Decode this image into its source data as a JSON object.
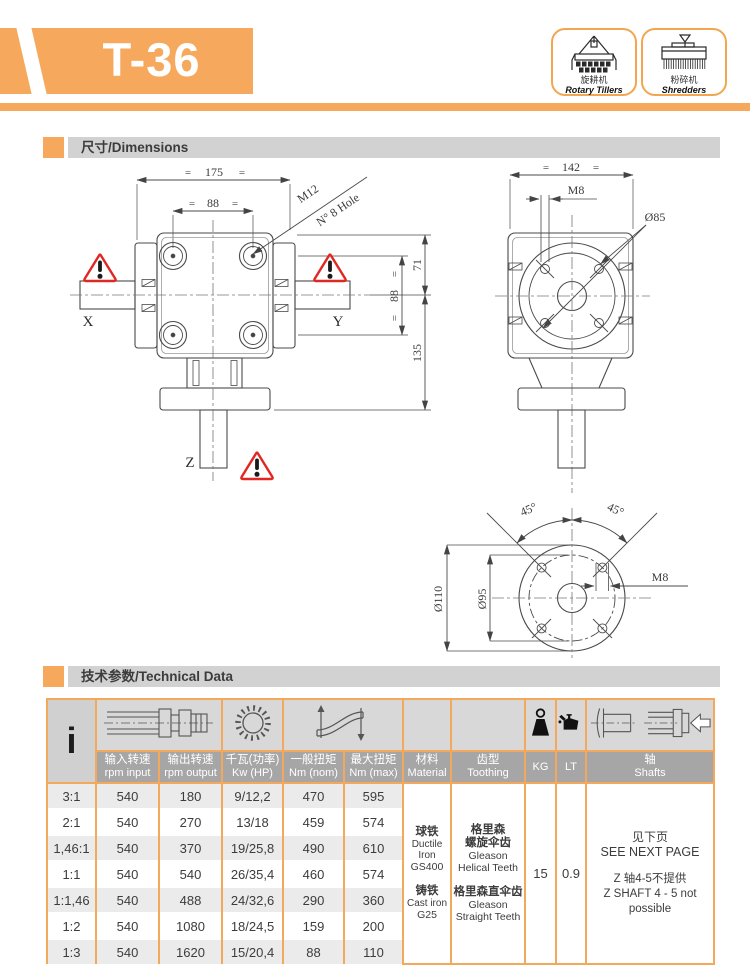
{
  "header": {
    "model": "T-36",
    "machines": [
      {
        "cn": "旋耕机",
        "en": "Rotary Tillers"
      },
      {
        "cn": "粉碎机",
        "en": "Shredders"
      }
    ]
  },
  "sections": {
    "dimensions": {
      "title": "尺寸/Dimensions"
    },
    "technical": {
      "title": "技术参数/Technical Data"
    }
  },
  "drawing": {
    "front": {
      "eq": "=",
      "dim_total": "175",
      "dim_holes": "88",
      "callout1": "M12",
      "callout2": "N° 8 Hole",
      "dim_h_top": "71",
      "dim_h_mid": "88",
      "dim_h_bot": "135",
      "x": "X",
      "y": "Y",
      "z": "Z"
    },
    "side": {
      "eq": "=",
      "dim_total": "142",
      "m8": "M8",
      "d85": "Ø85"
    },
    "flange": {
      "a1": "45°",
      "a2": "45°",
      "d110": "Ø110",
      "d95": "Ø95",
      "m8": "M8"
    }
  },
  "table": {
    "ratio_symbol": "i",
    "columns": [
      {
        "cn": "输入转速",
        "en": "rpm input"
      },
      {
        "cn": "输出转速",
        "en": "rpm output"
      },
      {
        "cn": "千瓦(功率)",
        "en": "Kw (HP)"
      },
      {
        "cn": "一般扭矩",
        "en": "Nm (nom)"
      },
      {
        "cn": "最大扭矩",
        "en": "Nm (max)"
      },
      {
        "cn": "材料",
        "en": "Material"
      },
      {
        "cn": "齿型",
        "en": "Toothing"
      },
      {
        "cn": "",
        "en": "KG"
      },
      {
        "cn": "",
        "en": "LT"
      },
      {
        "cn": "轴",
        "en": "Shafts"
      }
    ],
    "rows": [
      {
        "ratio": "3:1",
        "input": "540",
        "output": "180",
        "kw_hp": "9/12,2",
        "nm_nom": "470",
        "nm_max": "595"
      },
      {
        "ratio": "2:1",
        "input": "540",
        "output": "270",
        "kw_hp": "13/18",
        "nm_nom": "459",
        "nm_max": "574"
      },
      {
        "ratio": "1,46:1",
        "input": "540",
        "output": "370",
        "kw_hp": "19/25,8",
        "nm_nom": "490",
        "nm_max": "610"
      },
      {
        "ratio": "1:1",
        "input": "540",
        "output": "540",
        "kw_hp": "26/35,4",
        "nm_nom": "460",
        "nm_max": "574"
      },
      {
        "ratio": "1:1,46",
        "input": "540",
        "output": "488",
        "kw_hp": "24/32,6",
        "nm_nom": "290",
        "nm_max": "360"
      },
      {
        "ratio": "1:2",
        "input": "540",
        "output": "1080",
        "kw_hp": "18/24,5",
        "nm_nom": "159",
        "nm_max": "200"
      },
      {
        "ratio": "1:3",
        "input": "540",
        "output": "1620",
        "kw_hp": "15/20,4",
        "nm_nom": "88",
        "nm_max": "110"
      }
    ],
    "material": {
      "cn1": "球铁",
      "en1": "Ductile Iron",
      "gr1": "GS400",
      "cn2": "铸铁",
      "en2": "Cast iron",
      "gr2": "G25"
    },
    "toothing": {
      "cn1a": "格里森",
      "cn1b": "螺旋伞齿",
      "en1a": "Gleason",
      "en1b": "Helical Teeth",
      "cn2": "格里森直伞齿",
      "en2a": "Gleason",
      "en2b": "Straight Teeth"
    },
    "kg": "15",
    "lt": "0.9",
    "shafts_note": {
      "cn1": "见下页",
      "en1": "SEE NEXT PAGE",
      "cn2": "Z 轴4-5不提供",
      "en2": "Z SHAFT 4 - 5 not possible"
    }
  },
  "colors": {
    "orange": "#F6A95C",
    "border_orange": "#F3A85C",
    "bar_gray": "#D2D2D2",
    "label_gray": "#A6A6A6",
    "row_gray": "#EBEBEB",
    "warning_red": "#E02722"
  }
}
